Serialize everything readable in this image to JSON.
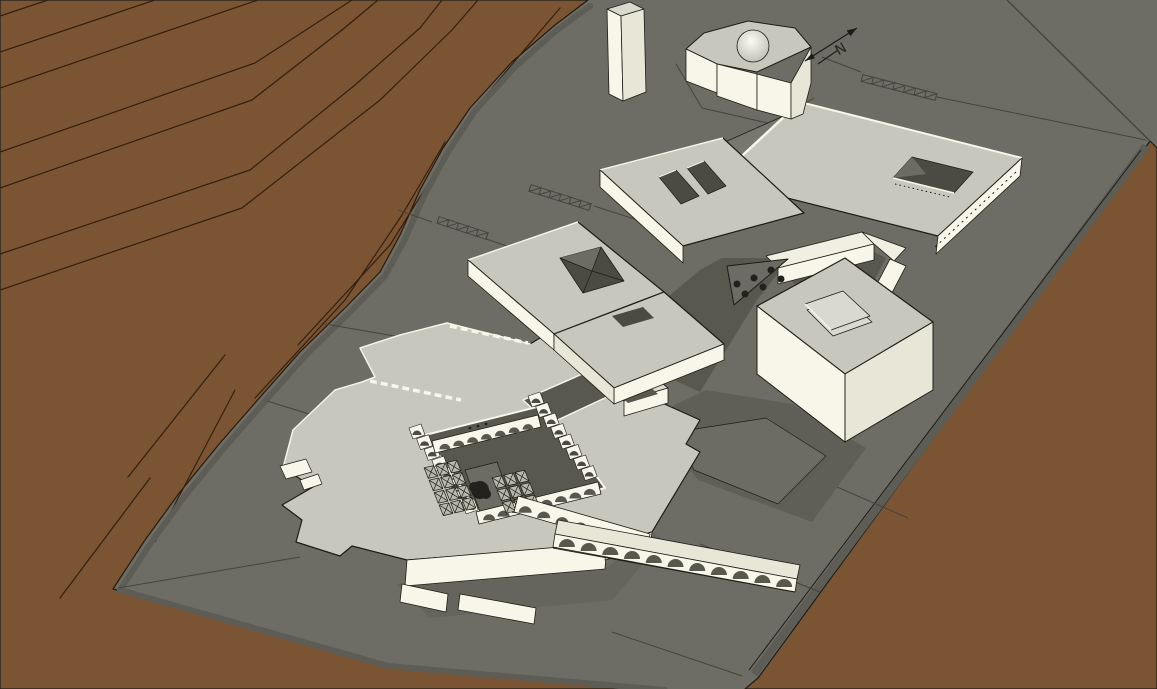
{
  "scene": {
    "type": "architectural-3d-site-model",
    "view": "axonometric",
    "north_arrow_label": "N",
    "counts": {
      "triangle_plaza_trees": 6,
      "hatched_ramp_strips": 3,
      "roof_slots_main_building": 2,
      "long_arcade_arches": 11,
      "upper_arcade_arches": 7
    },
    "colors": {
      "terrain": "#7a5433",
      "terrain_contour": "#33200f",
      "site": "#6d6d66",
      "site_dark": "#5d5d56",
      "site_line": "#45453e",
      "court": "#58584f",
      "court2": "#5f5f58",
      "court3": "#6c6c64",
      "roof": "#c7c7bd",
      "roof_light": "#d9d9cf",
      "roof_shade": "#77776f",
      "wall": "#f7f6e9",
      "wall_top": "#f0efe1",
      "wall_shade": "#e8e6d7",
      "grid_cell": "#b7b7ac",
      "apron": "#65655d",
      "opening": "#4b4b44",
      "outline": "#1d1d17",
      "dome_hi": "#fbfbf3",
      "dome_lo": "#bcbcb4",
      "tree": "#22221c"
    },
    "elements": [
      "terrain-with-contours",
      "site-plane",
      "site-boundary",
      "tower",
      "domed-building",
      "north-arrow",
      "hatched-ramp",
      "main-building-complex",
      "roof-lightwell",
      "roof-slots",
      "slab-building-with-roof-opening",
      "cube-building-with-skylight",
      "triangular-plaza-with-trees",
      "sunken-courtyard-complex",
      "arched-arcade",
      "courtyard-tree",
      "courtyard-x-grid",
      "stepped-entry"
    ]
  }
}
